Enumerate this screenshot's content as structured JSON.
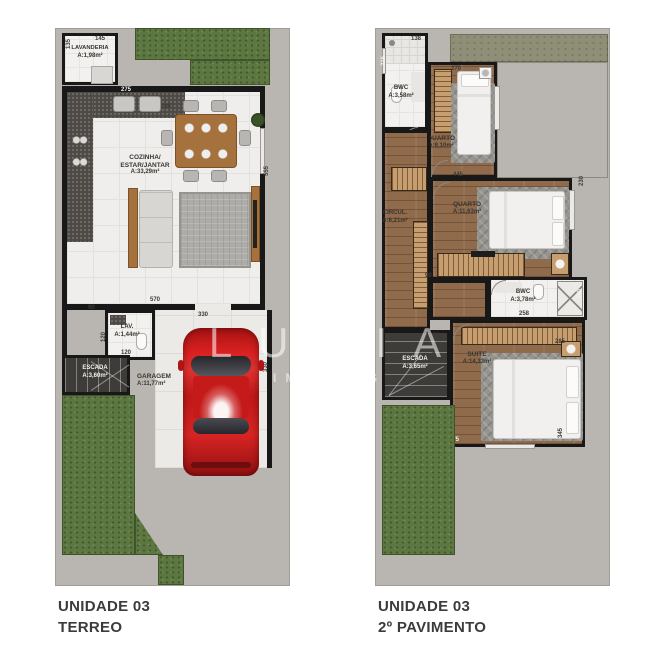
{
  "captions": {
    "left": [
      "UNIDADE 03",
      "TERREO"
    ],
    "right": [
      "UNIDADE 03",
      "2º PAVIMENTO"
    ]
  },
  "watermark": {
    "brand": "LUMIA",
    "tagline": "IMÓVEIS"
  },
  "floor1": {
    "rooms": {
      "lavanderia": {
        "name": "LAVANDERIA",
        "area": "A:1,98m²"
      },
      "cozinha": {
        "name1": "COZINHA/",
        "name2": "ESTAR/JANTAR",
        "area": "A:33,29m²"
      },
      "lav": {
        "name": "LAV.",
        "area": "A:1,44m²"
      },
      "escada": {
        "name": "ESCADA",
        "area": "A:3,60m²"
      },
      "garagem": {
        "name": "GARAGEM",
        "area": "A:11,77m²"
      }
    },
    "dims": {
      "d145": "145",
      "d135": "135",
      "d275": "275",
      "d295": "295",
      "d555": "555",
      "d570": "570",
      "d90": "90",
      "d120a": "120",
      "d120b": "120",
      "d330a": "330",
      "d330b": "330"
    }
  },
  "floor2": {
    "rooms": {
      "bwc1": {
        "name": "BWC",
        "area": "A:3,58m²"
      },
      "quarto1": {
        "name": "QUARTO",
        "area": "A:8,10m²"
      },
      "circul": {
        "name": "CIRCUL.",
        "area": "A:6,21m²"
      },
      "quarto2": {
        "name": "QUARTO",
        "area": "A:11,63m²"
      },
      "bwc2": {
        "name": "BWC",
        "area": "A:3,78m²"
      },
      "escada": {
        "name": "ESCADA",
        "area": "A:3,65m²"
      },
      "suite": {
        "name": "SUITE",
        "area": "A:14,33m²"
      }
    },
    "dims": {
      "d138": "138",
      "d215": "215",
      "d270": "270",
      "d90a": "90",
      "d445": "445",
      "d230": "230",
      "d90b": "90",
      "d258": "258",
      "d140": "140",
      "d99": "99",
      "d420": "420",
      "d285": "285",
      "d375": "375",
      "d345": "345"
    }
  },
  "colors": {
    "wall": "#181818",
    "lot_gray": "#b9b5b0",
    "garden_green": "#5c7840",
    "terrace_olive": "#8f8e76",
    "wood_floor": "#8f6a4b",
    "tile_floor": "#efeeec",
    "car_red": "#cf1b1b",
    "stairs_dark": "#3e3c39",
    "label_text": "#3e3933",
    "caption_text": "#3b3b3b",
    "watermark_white": "#ffffff"
  }
}
